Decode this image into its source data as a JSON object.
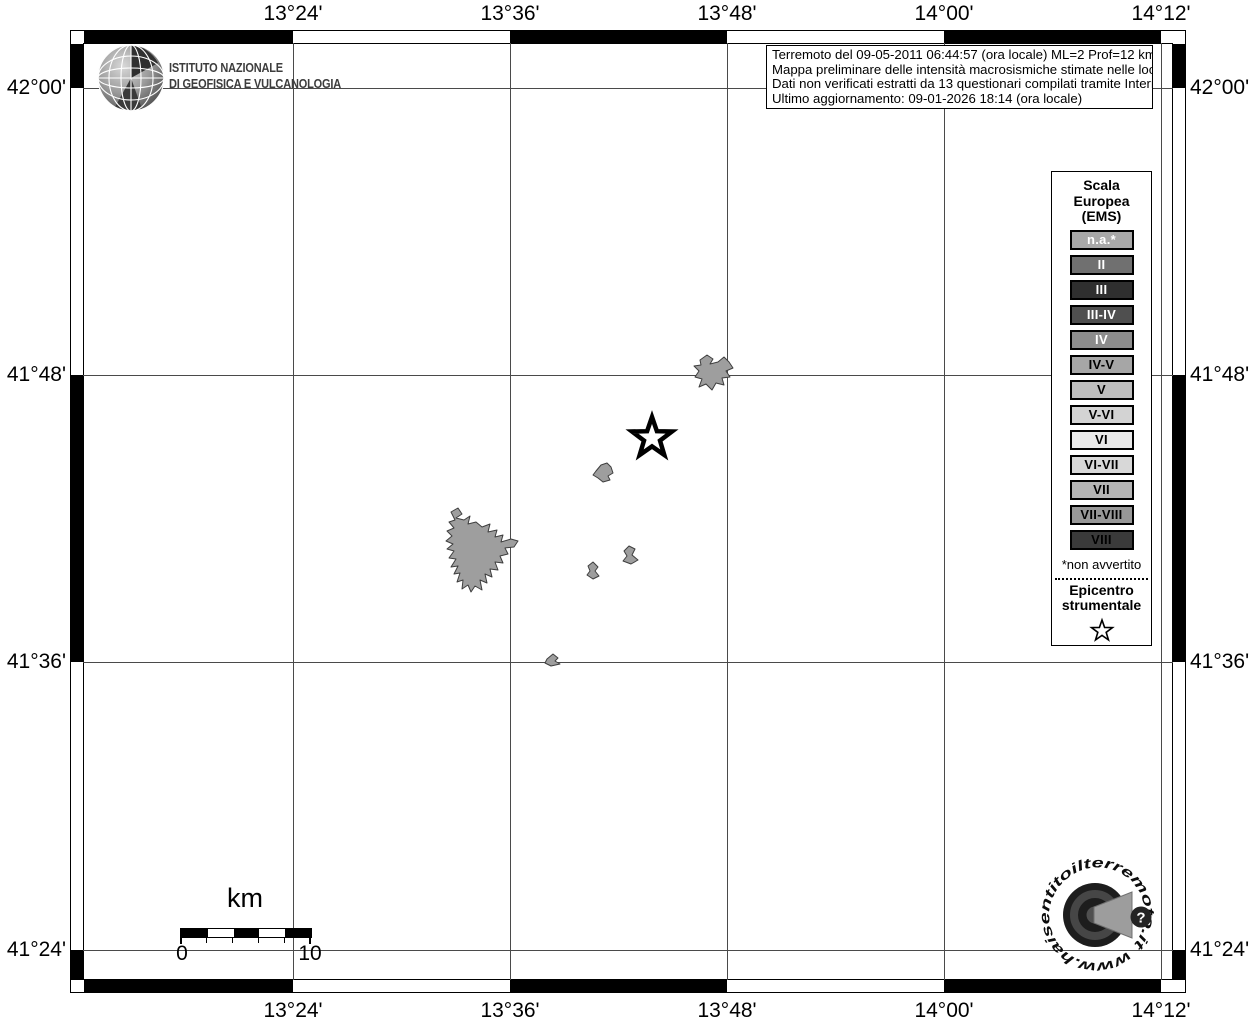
{
  "ingv_logo": {
    "line1": "ISTITUTO NAZIONALE",
    "line2": "DI GEOFISICA E VULCANOLOGIA"
  },
  "info_box": {
    "line1": "Terremoto del 09-05-2011 06:44:57 (ora locale) ML=2 Prof=12 km",
    "line2": "Mappa preliminare delle intensità macrosismiche stimate nelle località",
    "line3": "Dati non verificati estratti da 13 questionari compilati tramite Internet.",
    "line4": "Ultimo aggiornamento: 09-01-2026 18:14 (ora locale)"
  },
  "axes": {
    "top": [
      "13°24'",
      "13°36'",
      "13°48'",
      "14°00'",
      "14°12'"
    ],
    "bottom": [
      "13°24'",
      "13°36'",
      "13°48'",
      "14°00'",
      "14°12'"
    ],
    "left": [
      "42°00'",
      "41°48'",
      "41°36'",
      "41°24'"
    ],
    "right": [
      "42°00'",
      "41°48'",
      "41°36'",
      "41°24'"
    ]
  },
  "legend": {
    "title_line1": "Scala",
    "title_line2": "Europea",
    "title_line3": "(EMS)",
    "classes": [
      {
        "label": "n.a.*",
        "bg": "#a8a8a8",
        "fg": "#ffffff"
      },
      {
        "label": "II",
        "bg": "#707070",
        "fg": "#ffffff"
      },
      {
        "label": "III",
        "bg": "#2f2f2f",
        "fg": "#ffffff"
      },
      {
        "label": "III-IV",
        "bg": "#4f4f4f",
        "fg": "#ffffff"
      },
      {
        "label": "IV",
        "bg": "#8c8c8c",
        "fg": "#ffffff"
      },
      {
        "label": "IV-V",
        "bg": "#a6a6a6",
        "fg": "#000000"
      },
      {
        "label": "V",
        "bg": "#bdbdbd",
        "fg": "#000000"
      },
      {
        "label": "V-VI",
        "bg": "#d3d3d3",
        "fg": "#000000"
      },
      {
        "label": "VI",
        "bg": "#e9e9e9",
        "fg": "#000000"
      },
      {
        "label": "VI-VII",
        "bg": "#d8d8d8",
        "fg": "#000000"
      },
      {
        "label": "VII",
        "bg": "#b5b5b5",
        "fg": "#000000"
      },
      {
        "label": "VII-VIII",
        "bg": "#989898",
        "fg": "#000000"
      },
      {
        "label": "VIII",
        "bg": "#3a3a3a",
        "fg": "#000000"
      }
    ],
    "footnote": "*non avvertito",
    "epicenter_line1": "Epicentro",
    "epicenter_line2": "strumentale"
  },
  "scalebar": {
    "unit": "km",
    "min": "0",
    "max": "10"
  },
  "watermark": {
    "circular_text": "www.haisentitoilterremoto.it",
    "badge": "?"
  },
  "map_style": {
    "grid_color": "#4a4a4a",
    "locality_fill": "#9e9e9e",
    "locality_stroke": "#3e3e3e"
  }
}
